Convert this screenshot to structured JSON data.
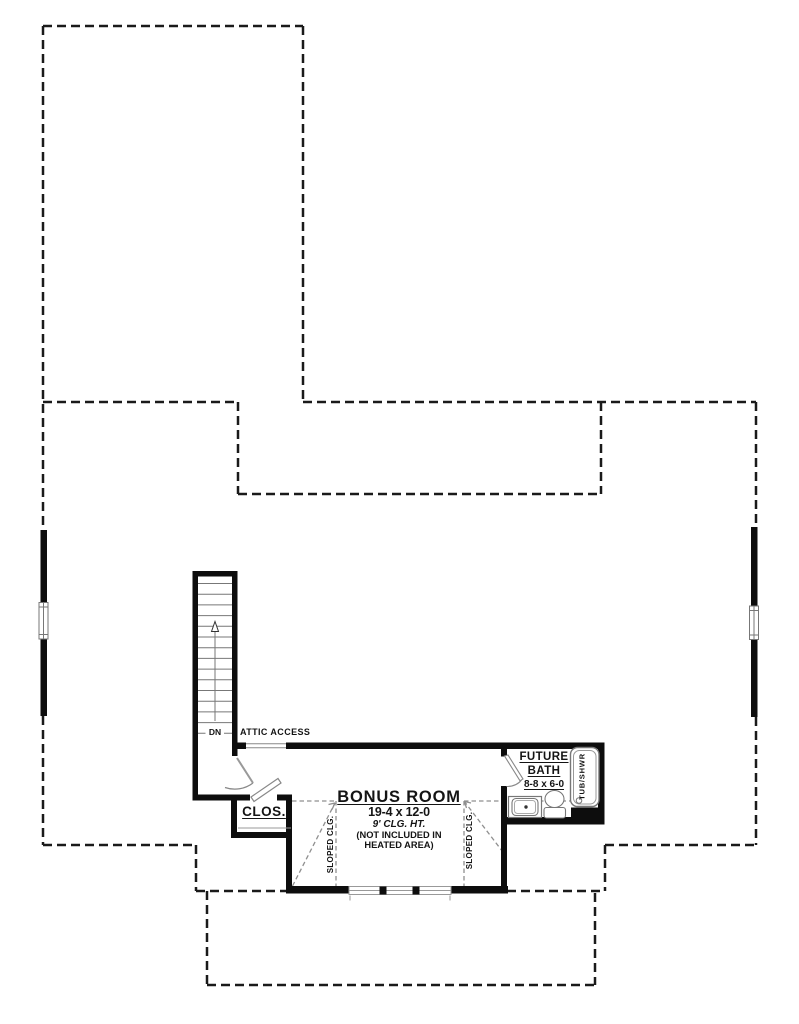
{
  "labels": {
    "attic_access": "ATTIC ACCESS",
    "down": "DN",
    "closet": "CLOS.",
    "bonus_title": "BONUS ROOM",
    "bonus_dims": "19-4 x 12-0",
    "bonus_ceiling": "9' CLG. HT.",
    "bonus_note_line1": "(NOT INCLUDED IN",
    "bonus_note_line2": "HEATED AREA)",
    "future_bath_line1": "FUTURE",
    "future_bath_line2": "BATH",
    "future_bath_dims": "8-8 x 6-0",
    "tub_shower": "TUB/SHWR",
    "sloped_ceiling_left": "SLOPED CLG.",
    "sloped_ceiling_right": "SLOPED CLG."
  },
  "colors": {
    "background": "#ffffff",
    "wall": "#0d0d0d",
    "roof_dash": "#1a1a1a",
    "thin_line": "#777777",
    "sloped_dash": "#8f8f8f",
    "text": "#141414"
  }
}
